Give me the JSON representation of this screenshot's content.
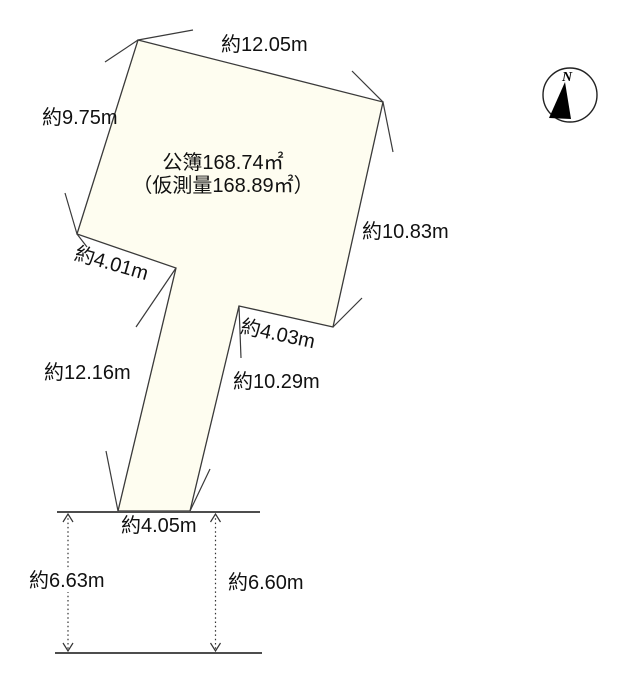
{
  "diagram": {
    "type": "land-survey-plot",
    "area_label": {
      "registered": "公簿168.74㎡",
      "provisional": "（仮測量168.89㎡）"
    },
    "compass": {
      "label": "N"
    },
    "dimensions": {
      "top_edge": "約12.05m",
      "upper_left_edge": "約9.75m",
      "right_edge": "約10.83m",
      "notch_left": "約4.01m",
      "notch_right": "約4.03m",
      "flagpole_left": "約12.16m",
      "flagpole_right": "約10.29m",
      "frontage": "約4.05m",
      "road_span_left": "約6.63m",
      "road_span_right": "約6.60m"
    },
    "colors": {
      "parcel_fill": "#FEFDF0",
      "boundary_line": "#3A3A3A",
      "road_line": "#4D4D4D",
      "text": "#111111",
      "background": "#FFFFFF"
    }
  }
}
